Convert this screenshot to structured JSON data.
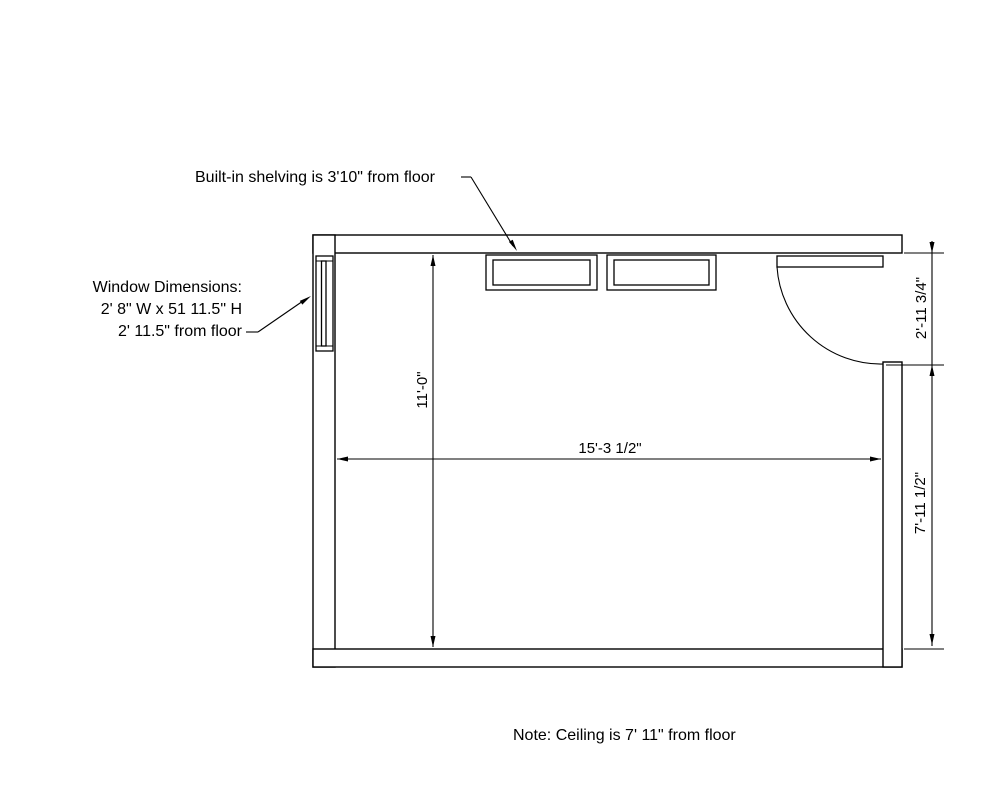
{
  "drawing": {
    "type": "floor-plan",
    "background_color": "#ffffff",
    "line_color": "#000000"
  },
  "annotations": {
    "shelving_note": "Built-in shelving is 3'10\" from floor",
    "window": {
      "line1": "Window Dimensions:",
      "line2": "2' 8\" W x 51 11.5\" H",
      "line3": "2' 11.5\" from floor"
    },
    "ceiling_note": "Note: Ceiling is 7' 11\" from floor"
  },
  "dimensions": {
    "room_depth": "11'-0\"",
    "room_width": "15'-3 1/2\"",
    "door_opening": "2'-11 3/4\"",
    "right_wall_segment": "7'-11 1/2\""
  }
}
